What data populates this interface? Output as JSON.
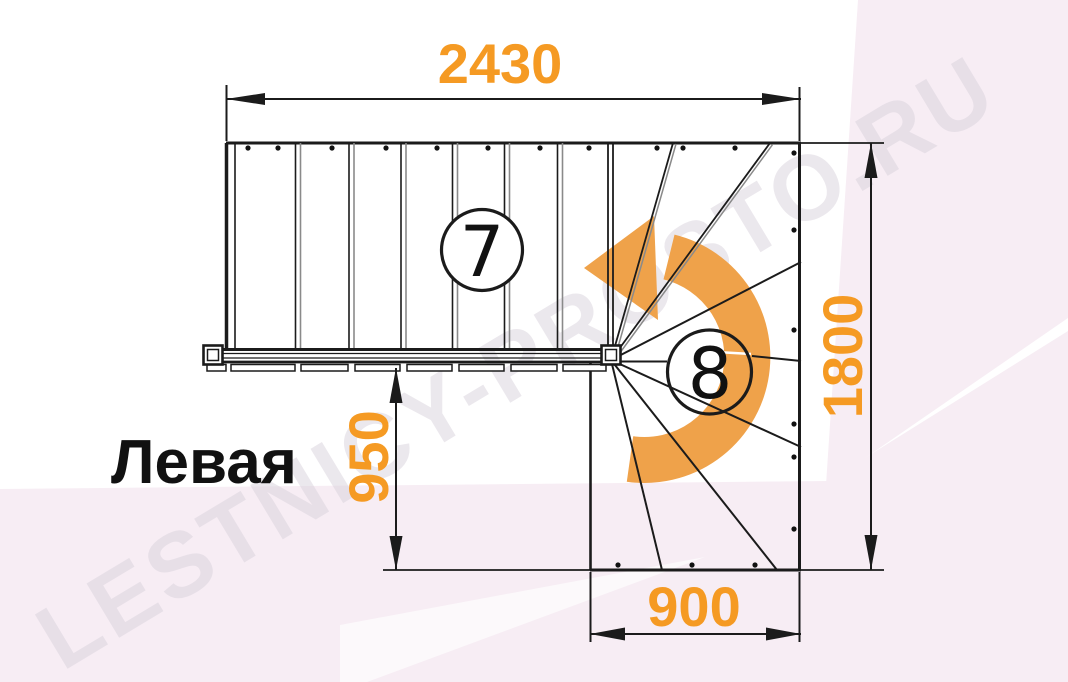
{
  "drawing": {
    "orientation_label": "Левая",
    "dimensions": {
      "total_width_top": "2430",
      "total_depth_right": "1800",
      "flight_offset_left": "950",
      "entry_width_bottom": "900"
    },
    "step_labels": {
      "straight_flight": "7",
      "winder_flight": "8"
    },
    "watermark": "LESTNICY-PROSTO.RU",
    "colors": {
      "dimension_text": "#F59A23",
      "turn_arrow": "#EFA24A",
      "line": "#1B1B1B",
      "background_tint": "#F7EDF4"
    }
  }
}
